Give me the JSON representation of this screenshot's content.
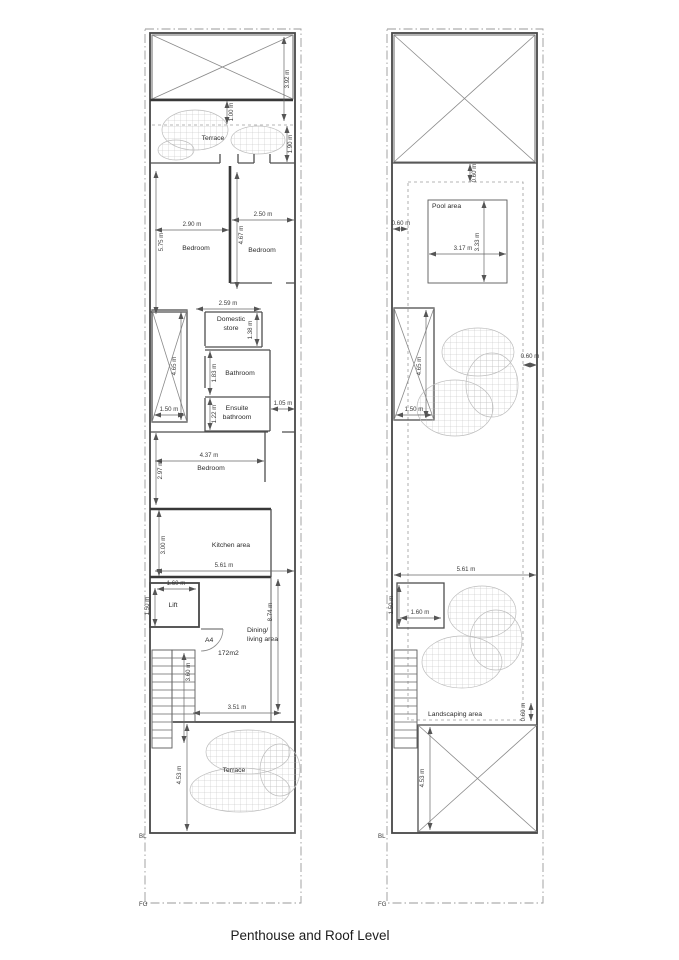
{
  "title": "Penthouse and Roof Level",
  "penthouse": {
    "name": "Penthouse",
    "rooms": {
      "terrace_top": "Terrace",
      "bedroom1": "Bedroom",
      "bedroom2": "Bedroom",
      "domestic_store_line1": "Domestic",
      "domestic_store_line2": "store",
      "bathroom": "Bathroom",
      "ensuite_line1": "Ensuite",
      "ensuite_line2": "bathroom",
      "bedroom3": "Bedroom",
      "kitchen": "Kitchen area",
      "lift": "Lift",
      "dining_line1": "Dining/",
      "dining_line2": "living area",
      "terrace_bottom": "Terrace"
    },
    "annotations": {
      "door_ref": "A4",
      "floor_area": "172m2",
      "building_line": "BL",
      "finish_grade": "FG"
    },
    "dims": {
      "rooflight_height": "3.92 m",
      "terrace_inset": "1.00 m",
      "terrace_depth": "1.90 m",
      "bedroom1_width": "2.90 m",
      "bedroom1_length": "5.75 m",
      "bedroom2_width": "2.50 m",
      "bedroom2_length": "4.67 m",
      "store_width": "2.59 m",
      "store_depth": "1.38 m",
      "stair_void_length": "4.65 m",
      "stair_void_width": "1.50 m",
      "bathroom_depth": "1.83 m",
      "ensuite_depth": "1.22 m",
      "corridor_width": "1.05 m",
      "bedroom3_width": "4.37 m",
      "bedroom3_depth": "2.97 m",
      "kitchen_depth": "3.00 m",
      "kitchen_width": "5.61 m",
      "lift_width": "1.60 m",
      "lift_depth": "1.50 m",
      "stair_length": "3.60 m",
      "living_length": "8.74 m",
      "living_width": "3.51 m",
      "terrace_bottom_depth": "4.53 m"
    }
  },
  "roof": {
    "name": "Roof",
    "rooms": {
      "pool": "Pool area",
      "landscaping": "Landscaping area"
    },
    "annotations": {
      "building_line": "BL",
      "finish_grade": "FG"
    },
    "dims": {
      "parapet_offset": "0.60 m",
      "edge_left": "0.60 m",
      "pool_width": "3.17 m",
      "pool_length": "3.33 m",
      "stair_void_length": "4.65 m",
      "stair_void_width": "1.50 m",
      "edge_right": "0.60 m",
      "roof_width": "5.61 m",
      "lift_width": "1.60 m",
      "lift_depth": "1.50 m",
      "edge_bottom": "0.60 m",
      "rooflight_depth": "4.53 m"
    }
  },
  "colors": {
    "wall": "#474747",
    "dimension": "#666666",
    "boundary": "#9a9a9a",
    "hatch": "#bdbdbd",
    "text": "#2b2b2b",
    "background": "#ffffff"
  }
}
